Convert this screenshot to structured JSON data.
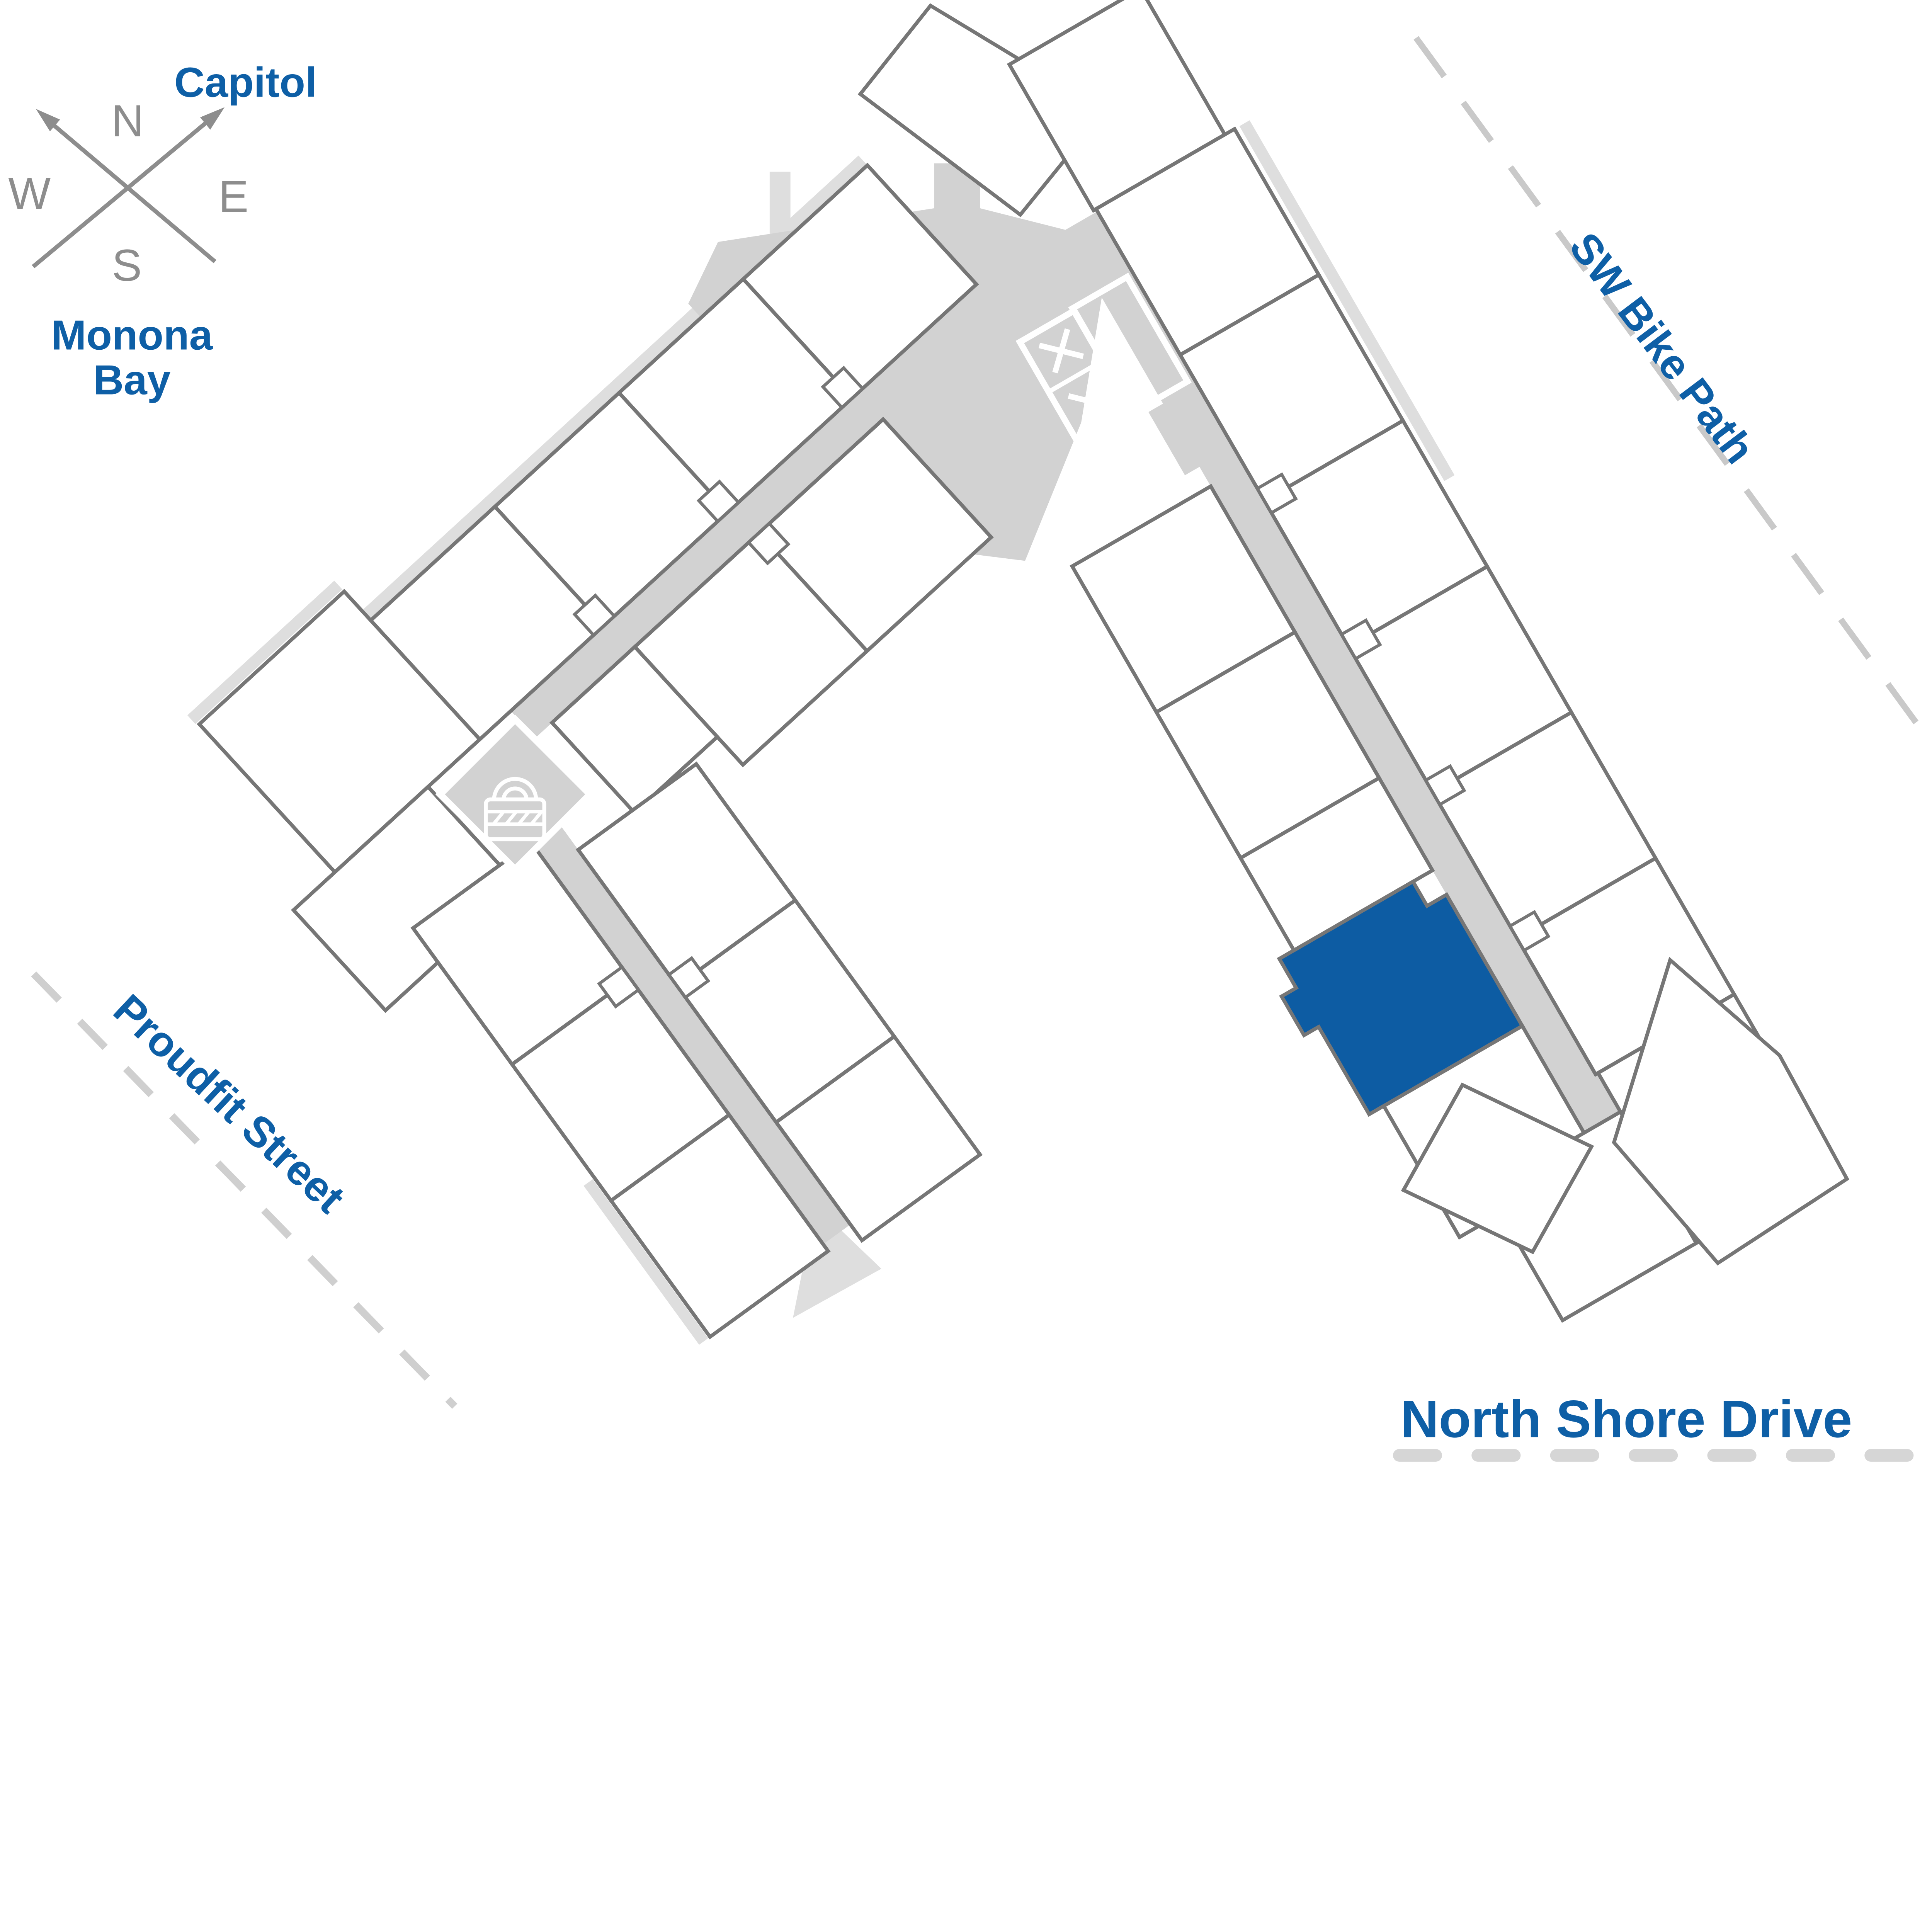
{
  "compass": {
    "north": "N",
    "south": "S",
    "east": "E",
    "west": "W"
  },
  "labels": {
    "capitol": "Capitol",
    "monona_bay_line1": "Monona",
    "monona_bay_line2": "Bay",
    "sw_bike_path": "SW Bike Path",
    "proudfit_street": "Proudfit Street",
    "north_shore_drive": "North Shore Drive"
  },
  "icons": {
    "elevator": "elevator-stairs-icon",
    "lock": "secure-lock-icon"
  },
  "colors": {
    "accent_blue": "#0e5fa6",
    "highlight_unit_fill": "#0d5ca3",
    "wall_gray": "#767676",
    "corridor_gray": "#d2d2d2",
    "pale_gray": "#dedede",
    "dash_gray": "#c9c9c9",
    "compass_gray": "#8d8d8d"
  }
}
